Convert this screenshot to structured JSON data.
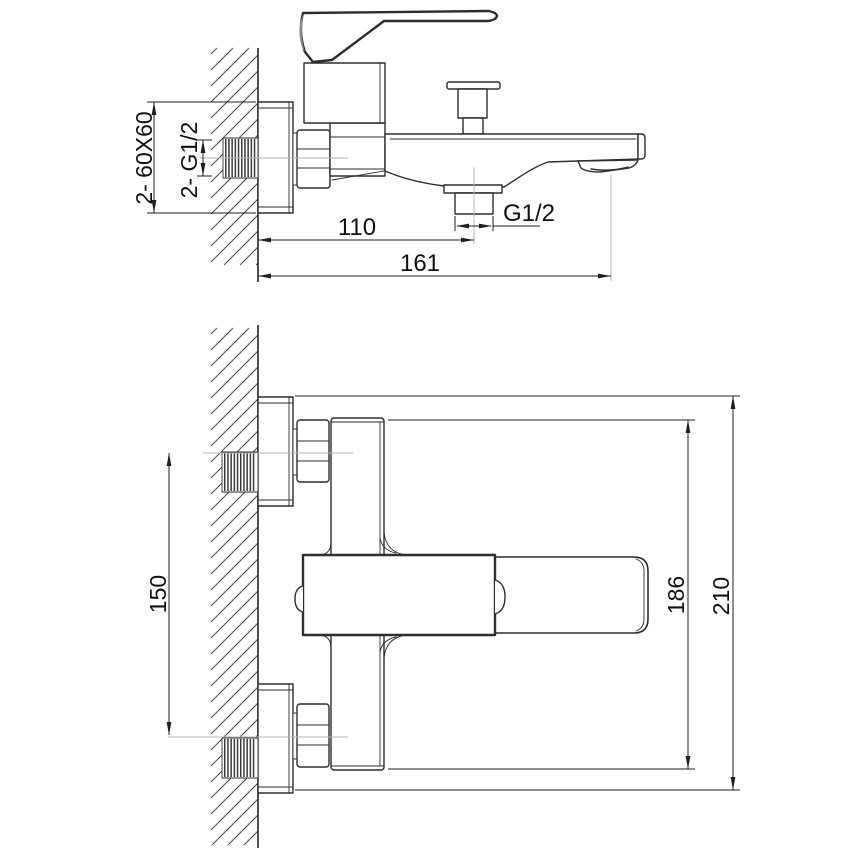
{
  "drawing": {
    "type": "technical-installation-drawing",
    "product": "wall-mounted bath mixer",
    "views": {
      "side_view": {
        "name": "side view",
        "labels": {
          "plate_size": "2- 60X60",
          "wall_thread": "2- G1/2",
          "spout_outlet_thread": "G1/2",
          "wall_to_outlet": "110",
          "wall_to_spout_tip": "161"
        }
      },
      "plan_view": {
        "name": "plan view",
        "labels": {
          "inlet_spacing": "150",
          "body_width": "186",
          "overall_width": "210"
        }
      }
    },
    "colors": {
      "line": "#2e2e2e",
      "dimension": "#1f1f1f",
      "centerline": "#b5b5b5",
      "hatch": "#474747",
      "background": "#ffffff"
    }
  }
}
